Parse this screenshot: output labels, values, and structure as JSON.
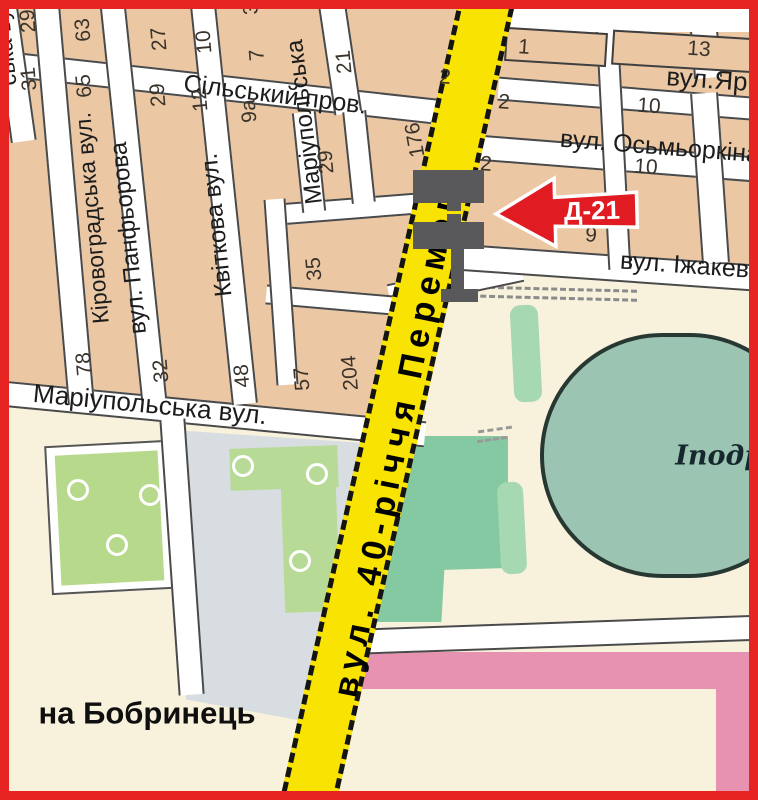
{
  "map": {
    "palette": {
      "border_red": "#e62421",
      "block_tan": "#ebc8a3",
      "street_white": "#ffffff",
      "casing_gray": "#4a4a4a",
      "main_road_yellow": "#f8e303",
      "park_green": "#b7d98c",
      "tree_strip_green": "#a6d8b2",
      "mid_green": "#85c9a2",
      "stadium_teal": "#9cc4b2",
      "gray_zone": "#d8dde1",
      "pink_zone": "#e892b2",
      "cream": "#f8f2dc",
      "billboard_gray": "#59595b",
      "arrow_red": "#e11b22"
    },
    "billboard": {
      "id_label": "Д-21"
    },
    "main_road": {
      "label": "вул. 40-річчя Перемоги"
    },
    "direction_note": "на Бобринець",
    "venue": "Іподром",
    "street_names": [
      "вул. 40-річчя Перемоги",
      "Сільський пров.",
      "Кіровоградська вул.",
      "вул. Панфьорова",
      "Квіткова вул.",
      "Маріупольська вул.",
      "вул.Яр",
      "вул. Осьмьоркіна",
      "вул. Іжакевича"
    ],
    "placed_labels": [
      {
        "name": "label-road-40-richchya",
        "kind": "road",
        "text": "вул. 40-річчя Перемоги",
        "x": 399,
        "y": 430,
        "rot": -78.5,
        "size": 34
      },
      {
        "name": "label-silskyi-prov",
        "kind": "street",
        "text": "Сільський пров.",
        "x": 275,
        "y": 95,
        "rot": 7,
        "size": 25
      },
      {
        "name": "label-kirovohradska",
        "kind": "street",
        "text": "Кіровоградська вул.",
        "x": 92,
        "y": 218,
        "rot": -95,
        "size": 23
      },
      {
        "name": "label-panfiorova",
        "kind": "street",
        "text": "вул. Панфьорова",
        "x": 129,
        "y": 238,
        "rot": -96,
        "size": 24
      },
      {
        "name": "label-kvitkova",
        "kind": "street",
        "text": "Квіткова вул.",
        "x": 217,
        "y": 225,
        "rot": -96,
        "size": 24
      },
      {
        "name": "label-mariupolska-vert",
        "kind": "street",
        "text": "Маріупольська",
        "x": 305,
        "y": 122,
        "rot": -97,
        "size": 24
      },
      {
        "name": "label-mariupolska-horiz",
        "kind": "street",
        "text": "Маріупольська вул.",
        "x": 150,
        "y": 404,
        "rot": 5.5,
        "size": 26
      },
      {
        "name": "label-yar",
        "kind": "street",
        "text": "вул.Яр",
        "x": 707,
        "y": 79,
        "rot": 4,
        "size": 26
      },
      {
        "name": "label-osmorkina",
        "kind": "street",
        "text": "вул. Осьмьоркіна",
        "x": 660,
        "y": 147,
        "rot": 4.5,
        "size": 25
      },
      {
        "name": "label-izhakevycha",
        "kind": "street",
        "text": "вул. Іжакевича",
        "x": 705,
        "y": 267,
        "rot": 4,
        "size": 25
      },
      {
        "name": "label-street-fragment",
        "kind": "street",
        "text": "ська вул.",
        "x": 4,
        "y": 38,
        "rot": -96,
        "size": 23
      },
      {
        "name": "label-na-bobrynets",
        "kind": "big",
        "text": "на Бобринець",
        "x": 147,
        "y": 713,
        "rot": 0,
        "size": 31
      },
      {
        "name": "label-ipodrom",
        "kind": "venue",
        "text": "Іподром",
        "x": 741,
        "y": 456,
        "rot": 0,
        "size": 27
      }
    ],
    "house_numbers": [
      {
        "text": "29",
        "x": 28,
        "y": 21,
        "rot": -95
      },
      {
        "text": "31",
        "x": 29,
        "y": 79,
        "rot": -95
      },
      {
        "text": "63",
        "x": 83,
        "y": 30,
        "rot": -95
      },
      {
        "text": "65",
        "x": 84,
        "y": 86,
        "rot": -95
      },
      {
        "text": "27",
        "x": 159,
        "y": 39,
        "rot": -95
      },
      {
        "text": "29",
        "x": 158,
        "y": 95,
        "rot": -95
      },
      {
        "text": "10",
        "x": 204,
        "y": 42,
        "rot": -95
      },
      {
        "text": "12",
        "x": 200,
        "y": 100,
        "rot": -95
      },
      {
        "text": "7",
        "x": 257,
        "y": 55,
        "rot": -95
      },
      {
        "text": "9а",
        "x": 249,
        "y": 111,
        "rot": -95
      },
      {
        "text": "3",
        "x": 251,
        "y": 9,
        "rot": -95
      },
      {
        "text": "21",
        "x": 344,
        "y": 62,
        "rot": -95
      },
      {
        "text": "176",
        "x": 415,
        "y": 140,
        "rot": -100
      },
      {
        "text": "29",
        "x": 326,
        "y": 162,
        "rot": -95
      },
      {
        "text": "35",
        "x": 314,
        "y": 269,
        "rot": -95
      },
      {
        "text": "78",
        "x": 84,
        "y": 364,
        "rot": -95
      },
      {
        "text": "32",
        "x": 161,
        "y": 371,
        "rot": -95
      },
      {
        "text": "48",
        "x": 242,
        "y": 376,
        "rot": -95
      },
      {
        "text": "57",
        "x": 302,
        "y": 379,
        "rot": -95
      },
      {
        "text": "204",
        "x": 350,
        "y": 373,
        "rot": -95
      },
      {
        "text": "2",
        "x": 445,
        "y": 77,
        "rot": 4
      },
      {
        "text": "2",
        "x": 504,
        "y": 102,
        "rot": 4
      },
      {
        "text": "1",
        "x": 524,
        "y": 47,
        "rot": 4
      },
      {
        "text": "13",
        "x": 699,
        "y": 49,
        "rot": 4
      },
      {
        "text": "10",
        "x": 649,
        "y": 106,
        "rot": 4
      },
      {
        "text": "2",
        "x": 486,
        "y": 164,
        "rot": 4
      },
      {
        "text": "10",
        "x": 646,
        "y": 167,
        "rot": 4
      },
      {
        "text": "9",
        "x": 591,
        "y": 235,
        "rot": 4
      }
    ],
    "streets_geometry": [
      {
        "name": "street-silskyi-prov",
        "cx": 240,
        "cy": 90,
        "len": 475,
        "th": 26,
        "rot": 6.3
      },
      {
        "name": "street-mariupolska-horiz",
        "cx": 213,
        "cy": 414,
        "len": 425,
        "th": 26,
        "rot": 5.5
      },
      {
        "name": "street-yar",
        "cx": 630,
        "cy": 99,
        "len": 265,
        "th": 24,
        "rot": 4.5
      },
      {
        "name": "street-osmorkina",
        "cx": 610,
        "cy": 158,
        "len": 300,
        "th": 26,
        "rot": 4.5
      },
      {
        "name": "street-izhakevycha-west",
        "cx": 455,
        "cy": 283,
        "len": 135,
        "th": 26,
        "rot": -12
      },
      {
        "name": "street-izhakevycha",
        "cx": 605,
        "cy": 267,
        "len": 315,
        "th": 27,
        "rot": 4
      },
      {
        "name": "street-bottom-right",
        "cx": 550,
        "cy": 635,
        "len": 420,
        "th": 26,
        "rot": -2
      },
      {
        "name": "street-mid-segment",
        "cx": 348,
        "cy": 209,
        "len": 150,
        "th": 22,
        "rot": -4.5
      },
      {
        "name": "street-mid-segment-2",
        "cx": 330,
        "cy": 300,
        "len": 128,
        "th": 20,
        "rot": 5
      },
      {
        "name": "street-left-edge",
        "cx": 14,
        "cy": 72,
        "len": 140,
        "th": 26,
        "rot": -98
      },
      {
        "name": "street-kirovohradska",
        "cx": 64,
        "cy": 205,
        "len": 398,
        "th": 27,
        "rot": -95
      },
      {
        "name": "street-panfiorova",
        "cx": 133,
        "cy": 203,
        "len": 395,
        "th": 26,
        "rot": -96
      },
      {
        "name": "street-kvitkova",
        "cx": 224,
        "cy": 205,
        "len": 400,
        "th": 26,
        "rot": -96
      },
      {
        "name": "street-mariupolska-vert",
        "cx": 340,
        "cy": 58,
        "len": 112,
        "th": 28,
        "rot": -98.5
      },
      {
        "name": "street-v-seg-a",
        "cx": 309,
        "cy": 162,
        "len": 100,
        "th": 24,
        "rot": -96
      },
      {
        "name": "street-v-seg-b",
        "cx": 359,
        "cy": 157,
        "len": 92,
        "th": 24,
        "rot": -96
      },
      {
        "name": "street-gray-boundary",
        "cx": 182,
        "cy": 557,
        "len": 276,
        "th": 26,
        "rot": -94
      },
      {
        "name": "street-v-seg-c",
        "cx": 281,
        "cy": 292,
        "len": 186,
        "th": 22,
        "rot": -94
      },
      {
        "name": "street-ne-top",
        "cx": 705,
        "cy": 42,
        "len": 72,
        "th": 28,
        "rot": -95
      },
      {
        "name": "street-ne-mid",
        "cx": 710,
        "cy": 178,
        "len": 170,
        "th": 28,
        "rot": -94
      },
      {
        "name": "street-ne-inner",
        "cx": 613,
        "cy": 138,
        "len": 262,
        "th": 23,
        "rot": -93
      }
    ]
  }
}
